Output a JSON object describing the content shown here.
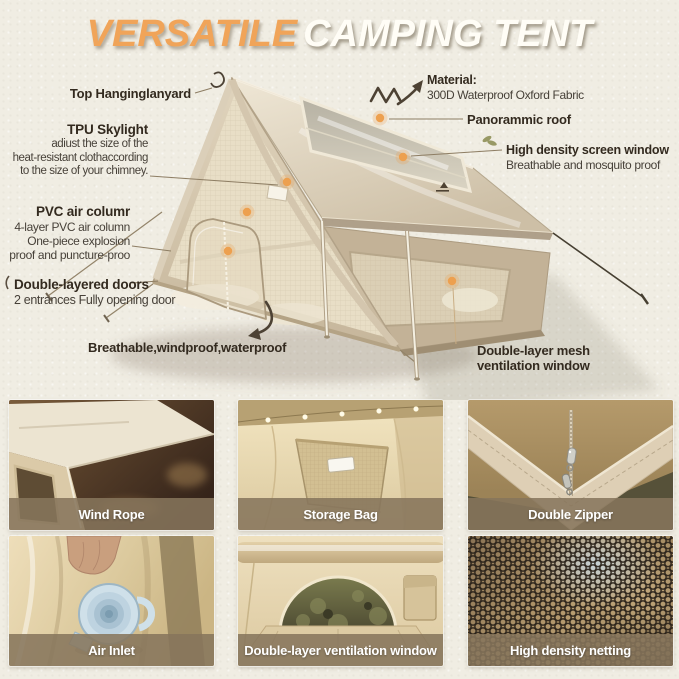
{
  "title": {
    "highlight": "VERSATILE",
    "rest": "CAMPING TENT"
  },
  "callouts": {
    "top_hanging_lanyard": {
      "label": "Top Hanginglanyard"
    },
    "tpu_skylight": {
      "label": "TPU Skylight",
      "desc": "adiust the size of the\nheat-resistant clothaccording\nto the size of your chimney."
    },
    "pvc_air_column": {
      "label": "PVC air columr",
      "desc": "4-layer PVC air column\nOne-piece explosion\nproof and puncture-proo"
    },
    "double_layered_doors": {
      "label": "Double-layered doors",
      "desc": "2 entrances Fully opening door"
    },
    "breathable": {
      "label": "Breathable,windproof,waterproof"
    },
    "material": {
      "label": "Material:",
      "desc": "300D Waterproof Oxford Fabric"
    },
    "panoramic_roof": {
      "label": "Panorammic roof"
    },
    "screen_window": {
      "label": "High density screen window",
      "desc": "Breathable and mosquito proof"
    },
    "mesh_vent_window": {
      "label": "Double-layer mesh\nventilation window"
    }
  },
  "gallery": {
    "items": [
      {
        "caption": "Wind Rope"
      },
      {
        "caption": "Storage Bag"
      },
      {
        "caption": "Double Zipper"
      },
      {
        "caption": "Air Inlet"
      },
      {
        "caption": "Double-layer ventilation window"
      },
      {
        "caption": "High density netting"
      }
    ]
  },
  "icons": {
    "callout_dot": "orange-dot",
    "material_arrow": "arrow-up-right",
    "breathable_arrow": "curved-arrow-down",
    "lanyard_hook": "hanging-hook",
    "decor_leaf": "leaf"
  },
  "colors": {
    "accent_orange": "#f0a459",
    "title_cream": "#fffdf6",
    "label_dark": "#332a1f",
    "caption_band": "#86755c",
    "tent_beige": "#d6c8b2",
    "background": "#f0ede3"
  }
}
